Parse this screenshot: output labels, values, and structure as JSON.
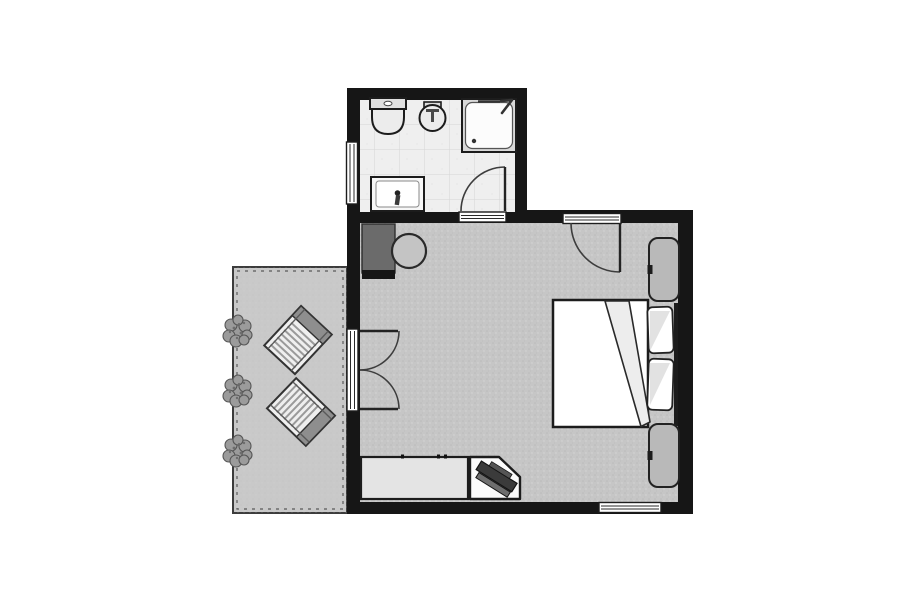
{
  "scene": {
    "type": "floor-plan",
    "rooms": [
      {
        "id": "bathroom",
        "fixtures": [
          "toilet",
          "bidet",
          "shower",
          "washbasin"
        ],
        "openings": [
          "left-wall-window",
          "door-to-bedroom"
        ]
      },
      {
        "id": "bedroom",
        "furniture": [
          "dark-desk",
          "round-stool",
          "double-bed",
          "pillow-top",
          "pillow-bottom",
          "nightstand-top",
          "nightstand-bottom",
          "sideboard",
          "corner-tv-stand",
          "tv"
        ],
        "openings": [
          "entry-door-top-wall",
          "french-doors-to-terrace",
          "bottom-wall-window"
        ]
      },
      {
        "id": "terrace",
        "furniture": [
          "sun-lounger-upper",
          "sun-lounger-lower"
        ],
        "planting": [
          "bush-top",
          "bush-middle",
          "bush-bottom"
        ]
      }
    ]
  },
  "palette": {
    "canvas": "#ffffff",
    "wall": "#161616",
    "carpet": "#c6c6c6",
    "terrace": "#c9c9c9",
    "bath_floor": "#efefef",
    "white": "#ffffff",
    "fixture": "#ececec",
    "shower_frame": "#d9d9d9",
    "furniture_gray": "#b9b9b9",
    "dark_desk": "#6b6b6b",
    "sideboard": "#e4e4e4",
    "tv_stand": "#fbfbfb",
    "stool": "#c4c4c4",
    "lounger": "#efefef",
    "lounger_band": "#8e8e8e",
    "bush": "#9b9b9b",
    "tv": "#3b3b3b",
    "tv_base": "#6e6e6e",
    "blanket": "#ededed",
    "pillow_shade": "#e2e2e2",
    "basin": "#f7f7f7"
  }
}
